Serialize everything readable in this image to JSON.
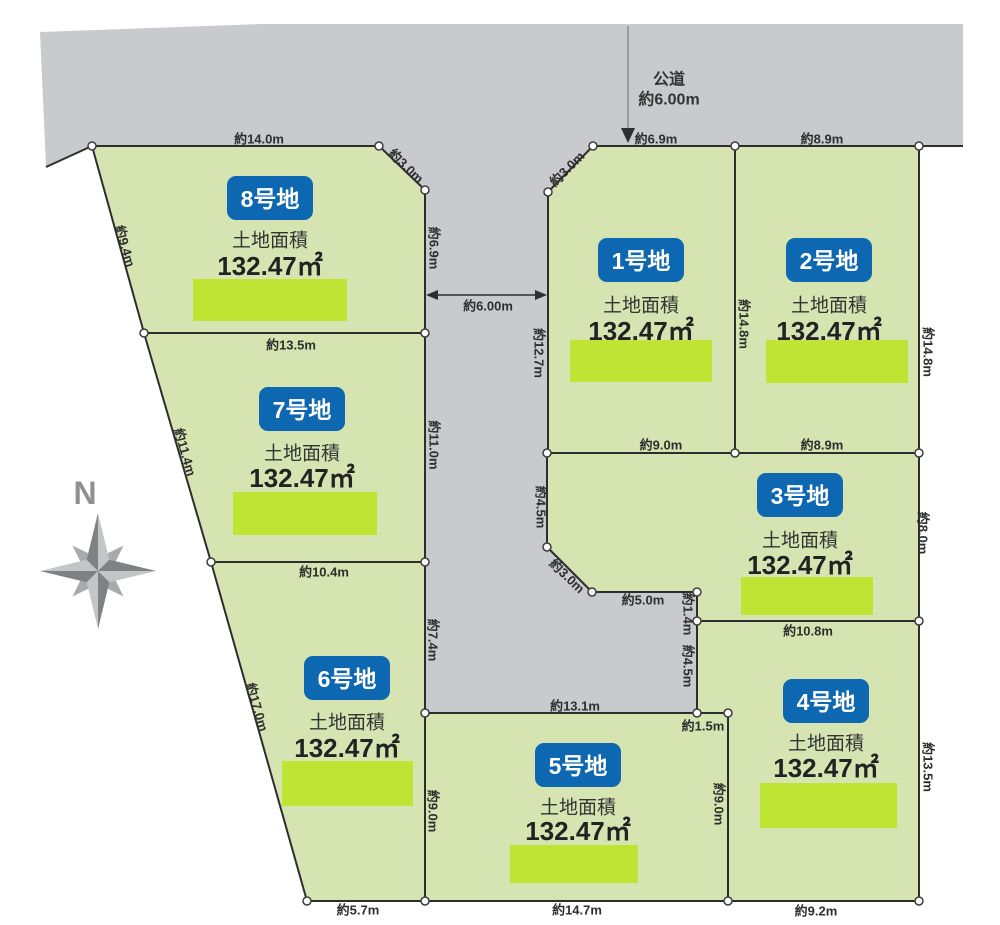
{
  "compass": {
    "north_label": "N"
  },
  "road": {
    "name": "公道",
    "width_label": "約6.00m",
    "cross_width_label": "約6.00m"
  },
  "colors": {
    "road_gray": "#c9cacd",
    "plot_green": "#d6e4b2",
    "bar_green": "#bfe434",
    "badge_blue": "#0d67b1"
  },
  "plots": [
    {
      "name": "1号地",
      "area_title": "土地面積",
      "area": "132.47㎡"
    },
    {
      "name": "2号地",
      "area_title": "土地面積",
      "area": "132.47㎡"
    },
    {
      "name": "3号地",
      "area_title": "土地面積",
      "area": "132.47㎡"
    },
    {
      "name": "4号地",
      "area_title": "土地面積",
      "area": "132.47㎡"
    },
    {
      "name": "5号地",
      "area_title": "土地面積",
      "area": "132.47㎡"
    },
    {
      "name": "6号地",
      "area_title": "土地面積",
      "area": "132.47㎡"
    },
    {
      "name": "7号地",
      "area_title": "土地面積",
      "area": "132.47㎡"
    },
    {
      "name": "8号地",
      "area_title": "土地面積",
      "area": "132.47㎡"
    }
  ],
  "dims": {
    "p8_top": "約14.0m",
    "p8_diag": "約3.0m",
    "p8_left": "約9.4m",
    "p8_right": "約6.9m",
    "p78": "約13.5m",
    "p7_left": "約11.4m",
    "p7_right": "約11.0m",
    "p67": "約10.4m",
    "p6_left": "約17.0m",
    "p6_road": "約7.4m",
    "p65": "約9.0m",
    "p6_bottom": "約5.7m",
    "p5_top": "約13.1m",
    "p5_bottom": "約14.7m",
    "p54": "約9.0m",
    "p45_step": "約1.5m",
    "p4_notch": "約4.5m",
    "p4_bottom": "約9.2m",
    "p4_right": "約13.5m",
    "p34": "約10.8m",
    "p3_jog": "約1.4m",
    "p3_south": "約5.0m",
    "p3_diag": "約3.0m",
    "p3_left": "約4.5m",
    "p3_right": "約8.0m",
    "p1_top": "約6.9m",
    "p2_top": "約8.9m",
    "p1_diag": "約3.0m",
    "p1_left": "約12.7m",
    "p12": "約14.8m",
    "p2_right": "約14.8m",
    "p13_bottom": "約9.0m",
    "p23_bottom": "約8.9m"
  }
}
